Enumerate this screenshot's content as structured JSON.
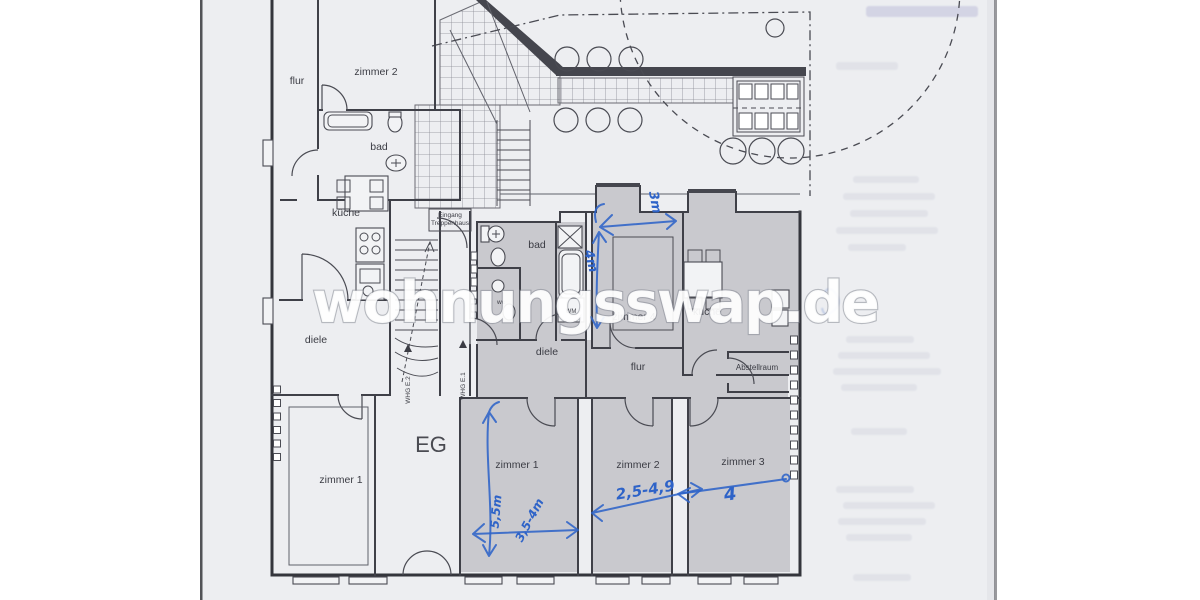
{
  "watermark": "wohnungsswap.de",
  "floor": {
    "label": "EG"
  },
  "stairwell": {
    "entrance_line1": "Eingang",
    "entrance_line2": "Treppenhaus",
    "whg_left": "WHG E.2",
    "whg_right": "WHG E.1"
  },
  "left_apartment": {
    "flur": "flur",
    "zimmer2": "zimmer 2",
    "bad": "bad",
    "kueche": "küche",
    "diele": "diele",
    "zimmer1": "zimmer 1"
  },
  "right_apartment": {
    "bad": "bad",
    "wc": "wc",
    "wm": "WM",
    "zimmer4": "zimmer 4",
    "kueche": "kuche",
    "diele": "diele",
    "flur": "flur",
    "abstellraum": "Abstellraum",
    "zimmer1": "zimmer 1",
    "zimmer2": "zimmer 2",
    "zimmer3": "zimmer 3"
  },
  "measurements": {
    "zimmer4_width": "3m",
    "zimmer4_height": "4m",
    "zimmer1_height": "5,5m",
    "zimmer1_width": "3,5-4m",
    "zimmer2_width": "2,5-4,9",
    "zimmer3_width": "4"
  },
  "colors": {
    "annotation_blue": "#2e63c8",
    "room_shading": "#c9c9ce",
    "paper": "#edeef1",
    "plan_line": "#3f4048"
  }
}
